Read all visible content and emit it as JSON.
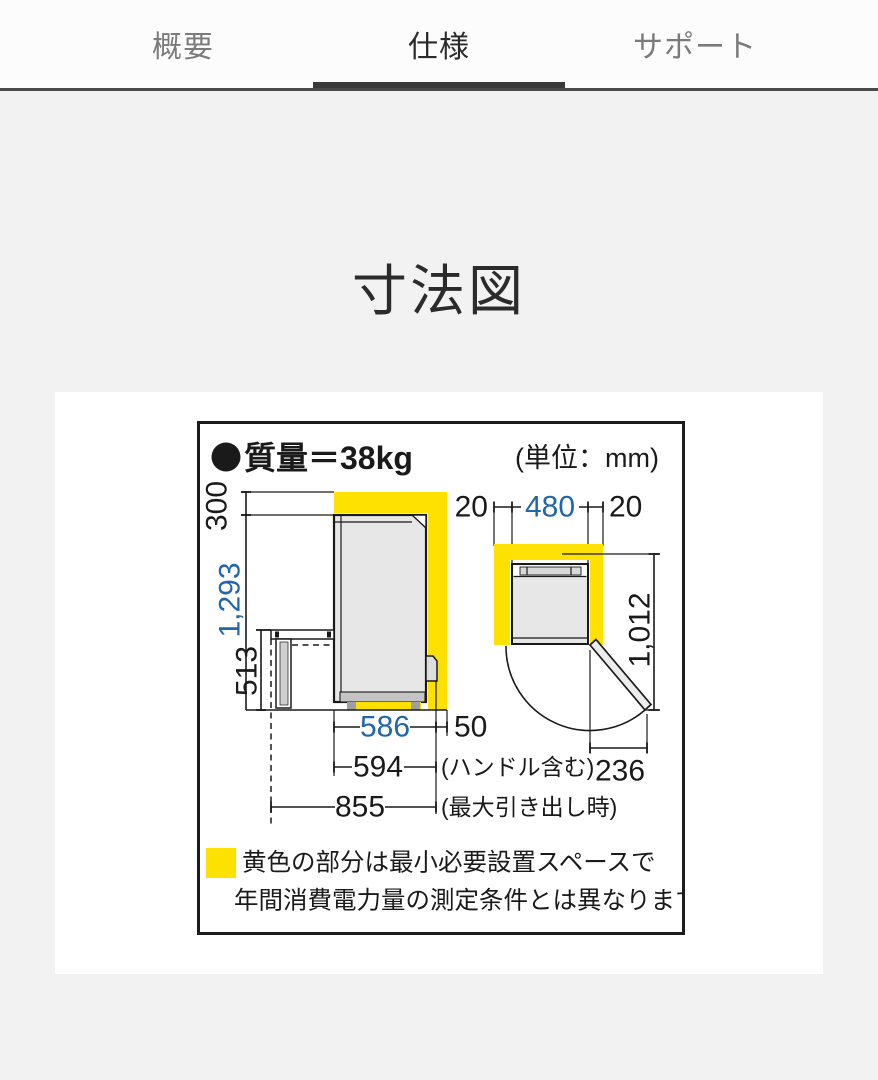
{
  "tab_bar": {
    "tabs": [
      {
        "label": "概要",
        "active": false
      },
      {
        "label": "仕様",
        "active": true
      },
      {
        "label": "サポート",
        "active": false
      }
    ]
  },
  "page": {
    "title": "寸法図"
  },
  "diagram": {
    "weight": "質量＝38kg",
    "unit": "(単位：mm)",
    "dims": {
      "top_clearance": "300",
      "body_height": "1,293",
      "drawer_front_height": "513",
      "body_depth": "586",
      "rear_clearance": "50",
      "depth_incl_handle": "594",
      "depth_incl_handle_note": "(ハンドル含む)",
      "depth_max_drawer": "855",
      "depth_max_drawer_note": "(最大引き出し時)",
      "side_clearance_left": "20",
      "body_width": "480",
      "side_clearance_right": "20",
      "depth_door_open": "1,012",
      "door_open_width": "236"
    },
    "legend": {
      "line1": "黄色の部分は最小必要設置スペースで",
      "line2": "年間消費電力量の測定条件とは異なります。"
    },
    "colors": {
      "highlight_yellow": "#ffe100",
      "dimension_blue": "#2266aa"
    }
  }
}
